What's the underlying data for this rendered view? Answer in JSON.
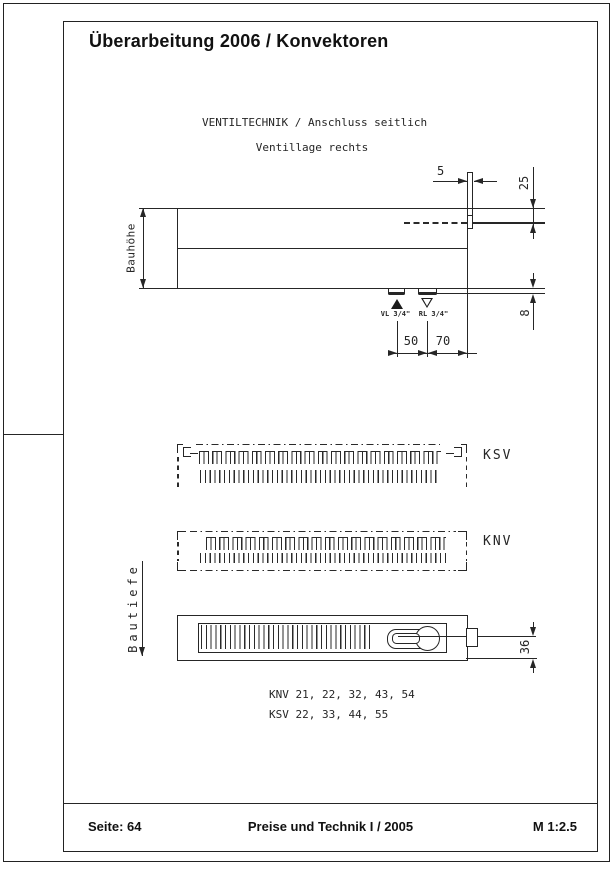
{
  "page": {
    "title": "Überarbeitung 2006 / Konvektoren",
    "footer": {
      "page_label": "Seite: 64",
      "center_label": "Preise und Technik  I / 2005",
      "scale_label": "M 1:2.5"
    }
  },
  "drawing": {
    "heading_line1": "VENTILTECHNIK / Anschluss seitlich",
    "heading_line2": "Ventillage rechts",
    "dims": {
      "bauhoehe_label": "Bauhöhe",
      "plate_width": "5",
      "top_offset": "25",
      "stub_height": "8",
      "vl_offset": "50",
      "rl_offset": "70",
      "bautiefe_label": "Bautiefe",
      "valve_center_offset": "36"
    },
    "connections": {
      "supply_label": "VL 3/4\"",
      "return_label": "RL 3/4\""
    },
    "views": {
      "ksv_label": "KSV",
      "knv_label": "KNV"
    },
    "models": {
      "knv_line": "KNV 21, 22, 32, 43, 54",
      "ksv_line": "KSV 22, 33, 44, 55"
    }
  },
  "colors": {
    "line": "#262626",
    "paper": "#ffffff"
  }
}
